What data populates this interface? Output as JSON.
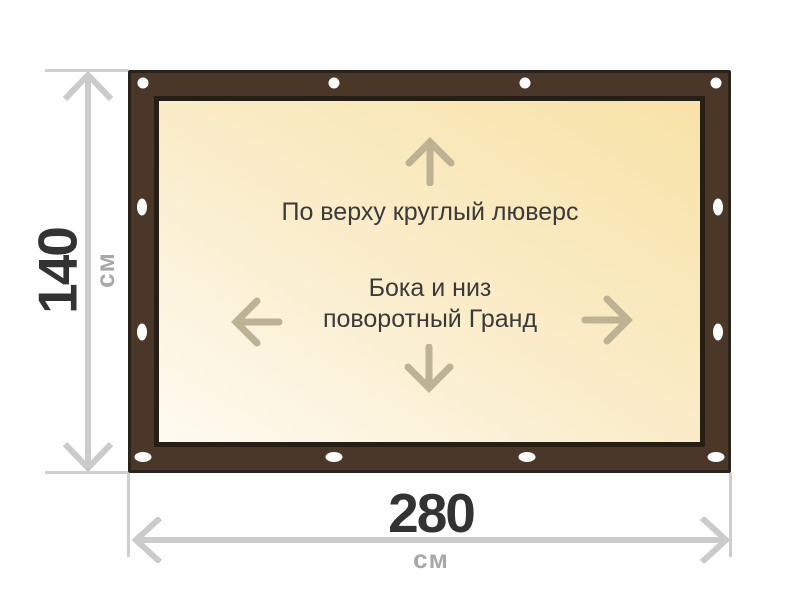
{
  "diagram": {
    "type": "banner-dimension-diagram",
    "annotations": {
      "top_note": "По верху круглый люверс",
      "middle_note_line1": "Бока и низ",
      "middle_note_line2": "поворотный Гранд"
    },
    "dimensions": {
      "height": {
        "value": "140",
        "unit": "см"
      },
      "width": {
        "value": "280",
        "unit": "см"
      }
    },
    "grommets": {
      "count": 12,
      "top_shape": "circle",
      "side_shape": "vertical-oval",
      "bottom_shape": "horizontal-oval",
      "color": "#FFFFFF"
    },
    "icons": {
      "up_arrow": "up-arrow-icon",
      "down_arrow": "down-arrow-icon",
      "left_arrow": "left-arrow-icon",
      "right_arrow": "right-arrow-icon",
      "height_dimension": "height-dimension-arrow-icon",
      "width_dimension": "width-dimension-arrow-icon",
      "round_grommet": "round-grommet-icon",
      "grand_fastener": "grand-fastener-icon"
    },
    "colors": {
      "background": "#FFFFFF",
      "frame": "#4A3728",
      "frame_outline": "#2A231B",
      "inner_border": "#261F16",
      "canvas_gradient_from": "#FFFBF2",
      "canvas_gradient_to": "#F8E2A7",
      "inner_arrows": "#BEB294",
      "dimension_lines": "#CBCBCB",
      "value_text": "#333333",
      "unit_text": "#A8A8A8",
      "note_text": "#3A3A3A"
    }
  }
}
